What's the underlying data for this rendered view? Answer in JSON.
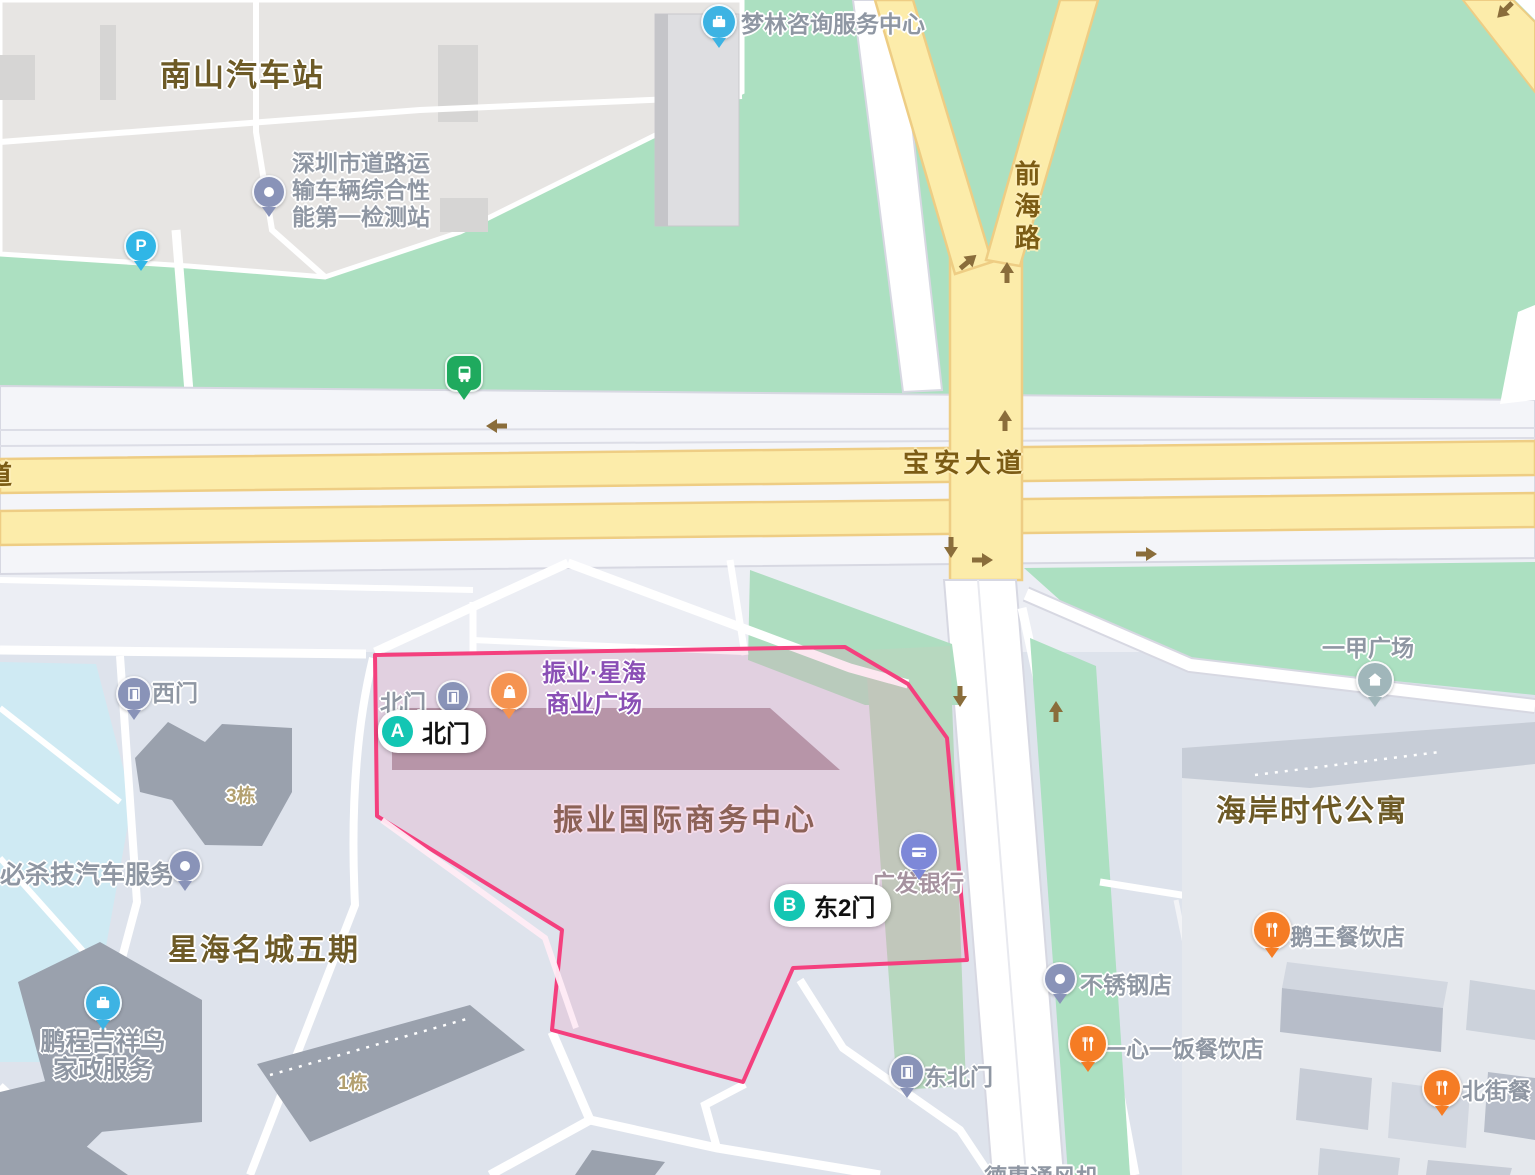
{
  "colors": {
    "park_green": "#ace0c1",
    "major_road_yellow": "#fcecaa",
    "highlight_fill": "rgba(241,120,172,0.18)",
    "highlight_border": "#f4407e",
    "gate_badge_teal": "#13c6b3",
    "restaurant_orange": "#f57c24",
    "company_blue": "#3db3e3",
    "bank_periwinkle": "#7d88d8",
    "generic_pin_slate": "#8993b8",
    "bus_green": "#1faa5e",
    "road_label_brown": "#7c5c15",
    "area_label_brown": "#6d5a26"
  },
  "roads": {
    "baoan_avenue": "宝安大道",
    "qianhai_road": "前海路",
    "partial_road_left": "道"
  },
  "areas": {
    "nanshan_bus_station": "南山汽车站",
    "xinghai_mingcheng_phase5": "星海名城五期",
    "haian_time_apartment": "海岸时代公寓",
    "zhenye_intl_business_center": "振业国际商务中心",
    "building_3": "3栋",
    "building_1": "1栋"
  },
  "pois": {
    "inspection_station": {
      "line1": "深圳市道路运",
      "line2": "输车辆综合性",
      "line3": "能第一检测站"
    },
    "menglin": "梦林咨询服务中心",
    "zhenye_xinghai_plaza": {
      "line1": "振业·星海",
      "line2": "商业广场"
    },
    "north_gate_small": "北门",
    "west_gate": "西门",
    "northeast_gate": "东北门",
    "guangfa_bank": "广发银行",
    "bishaji_auto": "必杀技汽车服务",
    "pengcheng": {
      "line1": "鹏程吉祥鸟",
      "line2": "家政服务"
    },
    "yijia_plaza": "一甲广场",
    "ewang_restaurant": "鹅王餐饮店",
    "stainless_steel_shop": "不锈钢店",
    "yixinyifan_restaurant": "一心一饭餐饮店",
    "beijie_restaurant_partial": "北街餐",
    "dehui_partial": "德惠通风机"
  },
  "gate_pills": {
    "a": {
      "letter": "A",
      "label": "北门"
    },
    "b": {
      "letter": "B",
      "label": "东2门"
    }
  }
}
